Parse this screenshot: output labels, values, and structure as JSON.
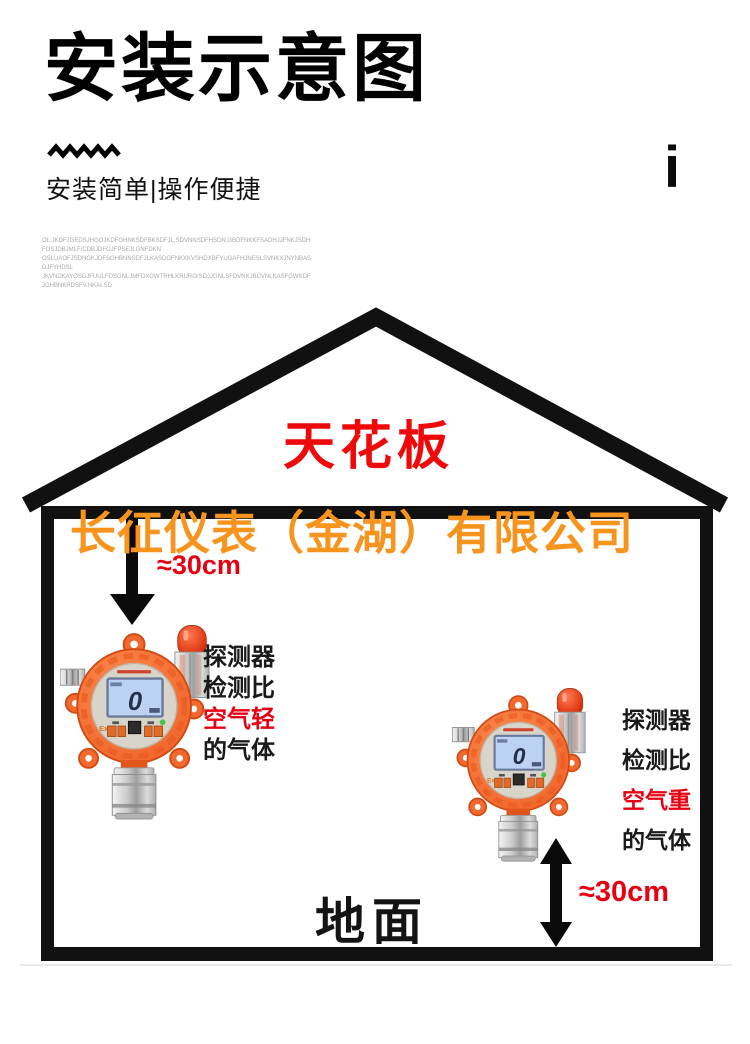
{
  "header": {
    "title": "安装示意图",
    "subtitle": "安装简单|操作便捷",
    "corner_mark": "i"
  },
  "fine_print": {
    "line1": "OL.JKDFJGEDSJHGOJKDFGHNKSDFBKSDFJL,SDVNNSDFHSDN,GBDFNKKFSADHJJFNKJSDHFOSJDBJMLF/CDBJDFOJFPSEJLGNFDKN",
    "line2": "OSLUAOFJSDNGKJDFSGHBNNSDFJLKASDGFNKXKVSHDXBFYUGAFHJNESLSVNKXJNYNBASDJFYHDSL",
    "line3": "JKVNDKAYOSDJFUULFDSGNLJMFDXGWTRHLKRURO/SDJJGNLSFDVNKJBCVNLKASFGWKDFJGHBNKRDSFV.NKALSD"
  },
  "diagram": {
    "ceiling_label": "天花板",
    "floor_label": "地面",
    "watermark": "长征仪表（金湖）有限公司",
    "left_unit": {
      "distance": "≈30cm",
      "caption_line1": "探测器",
      "caption_line2": "检测比",
      "caption_line3": "空气轻",
      "caption_line4": "的气体"
    },
    "right_unit": {
      "distance": "≈30cm",
      "caption_line1": "探测器",
      "caption_line2": "检测比",
      "caption_line3": "空气重",
      "caption_line4": "的气体"
    }
  },
  "device": {
    "lcd_value": "0",
    "ex_label": "Ex"
  },
  "colors": {
    "red_accent": "#e60012",
    "ceiling_red": "#ee0a0a",
    "watermark_orange": "#f7941d",
    "detector_orange": "#f2692f",
    "house_black": "#111111",
    "lcd_blue": "#bcd2f2"
  }
}
